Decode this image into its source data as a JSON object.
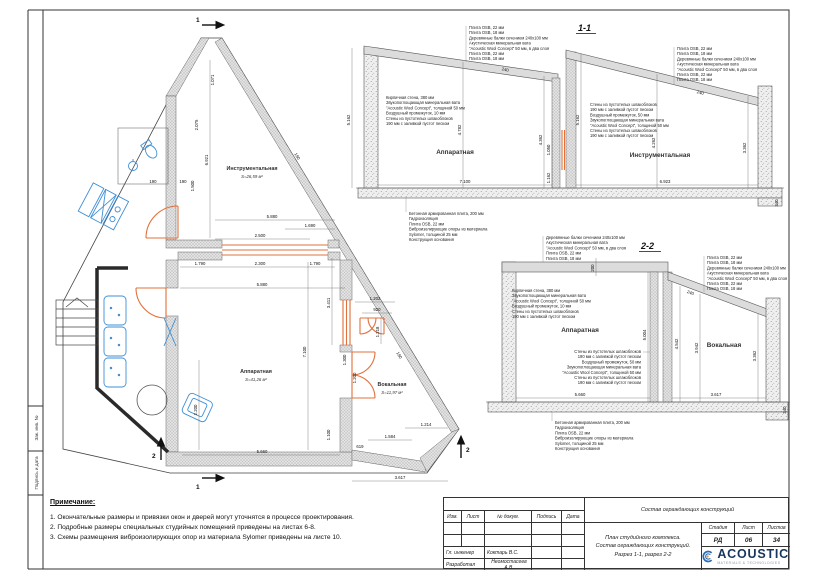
{
  "drawing": {
    "plan": {
      "rooms": [
        {
          "name": "Инструментальная",
          "area": "S=26,59 м²"
        },
        {
          "name": "Аппаратная",
          "area": "S=41,26 м²"
        },
        {
          "name": "Вокальная",
          "area": "S=11,97 м²"
        }
      ],
      "dims": {
        "v6921": "6.921",
        "v1071": "1.071",
        "v2075": "2.075",
        "v1500": "1.500",
        "w5880a": "5.880",
        "w1690": "1.690",
        "w2500": "2.500",
        "w1790a": "1.790",
        "w2300": "2.300",
        "w1790b": "1.790",
        "w5880b": "5.880",
        "v3411": "3.411",
        "v7100": "7.100",
        "v2200": "2.200",
        "w5660": "5.660",
        "v1100": "1.100",
        "w1202": "1.202",
        "w920": "920",
        "v1218": "1.218",
        "v1300": "1.300",
        "v1200": "1.200",
        "w619": "619",
        "w1584": "1.584",
        "w1214": "1.214",
        "w3617": "3.617",
        "t190a": "190",
        "t190b": "190",
        "t190c": "190",
        "t190d": "190"
      },
      "markers": {
        "top": "1",
        "bottom": "1",
        "left": "2",
        "right": "2"
      }
    },
    "sections": [
      {
        "title": "1-1",
        "room_left": "Аппаратная",
        "room_right": "Инструментальная",
        "dims": {
          "out_left": "5.162",
          "room_left_h": "4.782",
          "w_left": "7.100",
          "mid_h": "4.362",
          "mid_g1": "1.050",
          "mid_g2": "1.162",
          "roof_l": "240",
          "out_right": "5.162",
          "room_right_h": "4.262",
          "wall_right_h": "3.362",
          "w_right": "6.923",
          "roof_r": "240",
          "foot": "340"
        }
      },
      {
        "title": "2-2",
        "room_left": "Аппаратная",
        "room_right": "Вокальная",
        "dims": {
          "roof_t": "200",
          "h_left": "5.004",
          "h_mid": "4.542",
          "h_mid2": "3.942",
          "h_right": "3.362",
          "w_left": "5.660",
          "w_right": "3.617",
          "roof": "240",
          "foot": "340"
        }
      }
    ],
    "annotations": {
      "roof": [
        "Плита OSB, 22 мм",
        "Плита OSB, 18 мм",
        "Деревянные балки сечением 240х100 мм",
        "Акустическая минеральная вата",
        "\"Acoustic Wool Concept\" 50 мм, в два слоя",
        "Плита OSB, 22 мм",
        "Плита OSB, 18 мм"
      ],
      "roof_flat": [
        "Деревянные балки сечением 240х100 мм",
        "Акустическая минеральная вата",
        "\"Acoustic Wool Concept\" 50 мм, в два слоя",
        "Плита OSB, 22 мм",
        "Плита OSB, 18 мм"
      ],
      "wall_brick": [
        "Кирпичная стена, 380 мм",
        "Звукопоглощающая минеральная вата",
        "\"Acoustic Wool Concept\", толщиной 50 мм",
        "Воздушный промежуток, 10 мм",
        "Стены из пустотелых шлакоблоков",
        "190 мм с заливкой пустот песком"
      ],
      "wall_block": [
        "Стены из пустотелых шлакоблоков",
        "190 мм с заливкой пустот песком",
        "Воздушный промежуток, 50 мм",
        "Звукопоглощающая минеральная вата",
        "\"Acoustic Wool Concept\", толщиной 50 мм",
        "Стены из пустотелых шлакоблоков",
        "190 мм с заливкой пустот песком"
      ],
      "floor": [
        "Бетонная армированная плита, 200 мм",
        "Гидроизоляция",
        "Плита OSB, 22 мм",
        "Виброизолирующие опоры из материала",
        "Sylomer, толщиной 25 мм",
        "Конструкция основания"
      ]
    }
  },
  "notes": {
    "title": "Примечание:",
    "items": [
      "1. Окончательные размеры и привязки окон и дверей могут уточнятся в процессе проектирования.",
      "2. Подробные размеры специальных студийных помещений приведены на листах 6-8.",
      "3. Схемы размещения виброизолирующих опор из материала Sylomer приведены на листе 10."
    ]
  },
  "titleblock": {
    "doc_name": "Состав ограждающих конструкций",
    "cols": {
      "izm": "Изм.",
      "list": "Лист",
      "ndoc": "№ докум.",
      "sign": "Подпись",
      "date": "Дата"
    },
    "rows": [
      {
        "role": "Гл. инженер",
        "name": "Коктарь В.С."
      },
      {
        "role": "Разработал",
        "name": "Неомостасеев А.В."
      }
    ],
    "sheet_title": [
      "План студийного комплекса.",
      "Состав ограждающих конструкций.",
      "Разрез 1-1, разрез 2-2"
    ],
    "stage": {
      "h1": "Стадия",
      "h2": "Лист",
      "h3": "Листов",
      "v1": "РД",
      "v2": "06",
      "v3": "34"
    }
  },
  "stamp_side": {
    "label1": "Зак. инв. №",
    "label2": "Подпись и дата"
  },
  "logo": {
    "name": "ACOUSTIC",
    "tagline": "MATERIALS & TECHNOLOGIES"
  },
  "colors": {
    "accent_orange": "#e2703a",
    "furniture_blue": "#3f8fd6",
    "logo_navy": "#16355f",
    "logo_orange": "#ef8b2c"
  }
}
